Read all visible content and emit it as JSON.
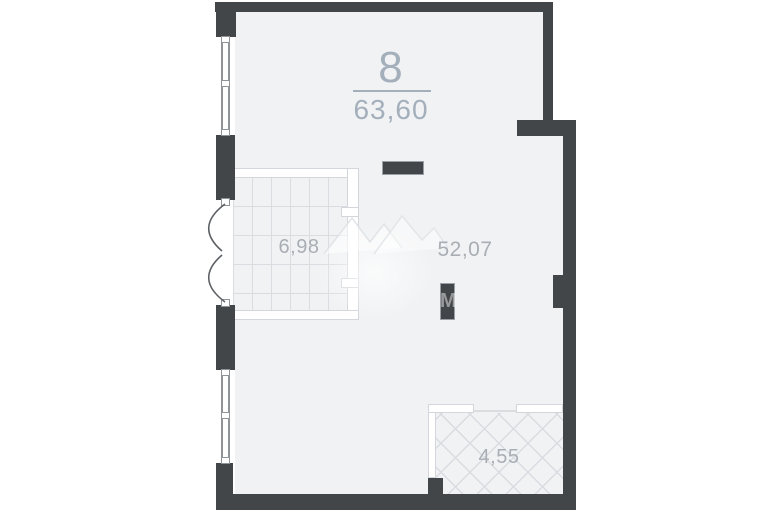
{
  "floorplan": {
    "unit": {
      "number": "8",
      "total_area": "63,60"
    },
    "rooms": [
      {
        "id": "loggia",
        "area": "6,98",
        "pattern": "square-grid"
      },
      {
        "id": "main-room",
        "area": "52,07",
        "pattern": "none"
      },
      {
        "id": "bathroom",
        "area": "4,55",
        "pattern": "diagonal-hatch"
      }
    ],
    "watermark": {
      "icon": "mountain-logo-icon",
      "letter": "M"
    },
    "colors": {
      "wall": "#434649",
      "floor": "#f1f2f4",
      "grid_line": "#d9dce0",
      "partition_outline": "#d3d6da",
      "window_line": "#8f9499",
      "label": "#a9aeb5",
      "header": "#a4afbc",
      "threshold": "#dadde0"
    }
  }
}
